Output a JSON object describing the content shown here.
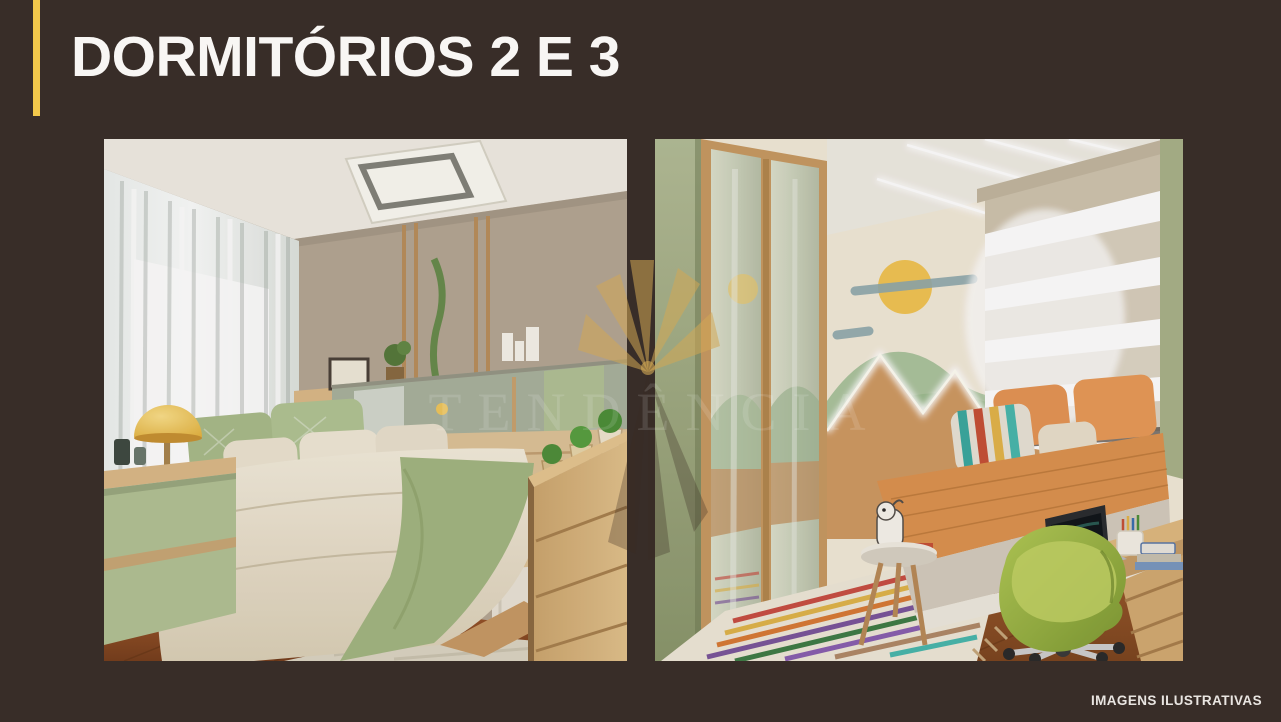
{
  "slide": {
    "title": "DORMITÓRIOS 2 E 3",
    "footer": "IMAGENS ILUSTRATIVAS"
  },
  "watermark": {
    "logo_icon": "palm-fan-logo",
    "text": "TENDÊNCIA"
  },
  "colors": {
    "background": "#382d28",
    "accent": "#f2c84b",
    "title": "#f8f6f4",
    "footer": "#e9e5e1",
    "watermark_gold": "#c99c4e"
  }
}
